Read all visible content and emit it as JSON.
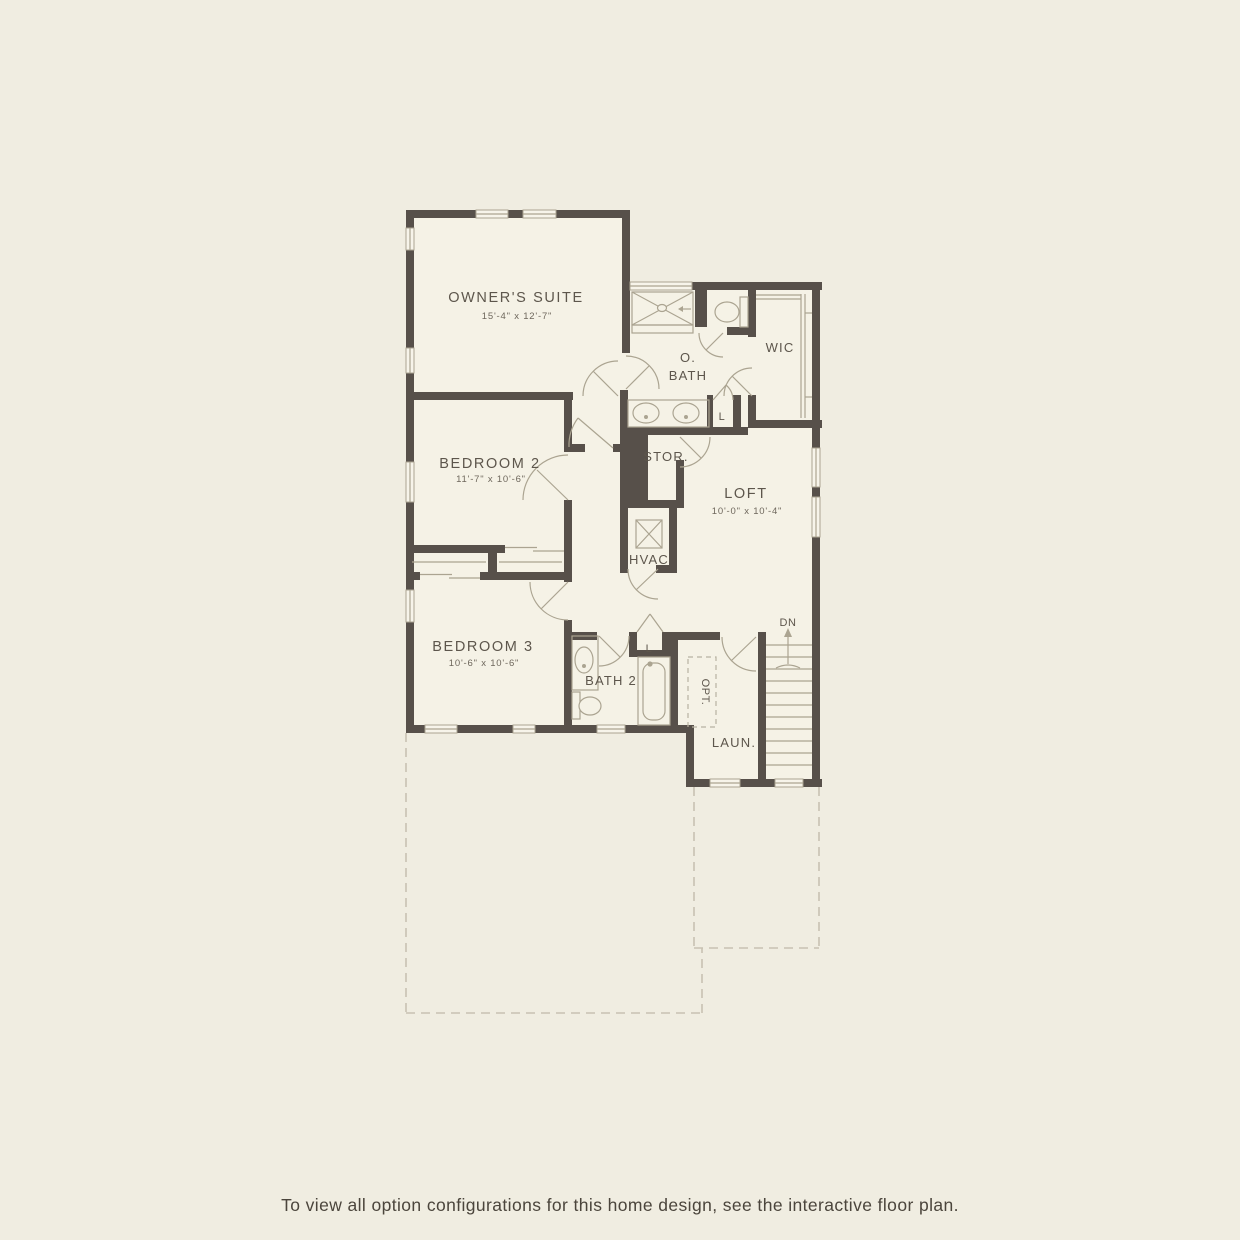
{
  "page": {
    "footer_note": "To view all option configurations for this home design, see the interactive floor plan."
  },
  "palette": {
    "background": "#f0ede1",
    "interior_floor": "#f5f2e6",
    "wall": "#57504a",
    "thin_line": "#aba491",
    "label_text": "#5d564c",
    "dashed_line": "#c8c2b2"
  },
  "floor_plan": {
    "rooms": {
      "owners_suite": {
        "name": "OWNER'S SUITE",
        "dims": "15'-4\" x 12'-7\""
      },
      "bedroom_2": {
        "name": "BEDROOM 2",
        "dims": "11'-7\" x 10'-6\""
      },
      "bedroom_3": {
        "name": "BEDROOM 3",
        "dims": "10'-6\" x 10'-6\""
      },
      "loft": {
        "name": "LOFT",
        "dims": "10'-0\" x 10'-4\""
      },
      "owners_bath": {
        "line1": "O.",
        "line2": "BATH"
      },
      "wic": {
        "name": "WIC"
      },
      "storage": {
        "name": "STOR."
      },
      "hvac": {
        "name": "HVAC"
      },
      "bath_2": {
        "name": "BATH 2"
      },
      "laundry": {
        "name": "LAUN."
      },
      "linen_bath": {
        "name": "L"
      },
      "linen_hall": {
        "name": "L"
      },
      "optional": {
        "name": "OPT."
      },
      "stairs_down": {
        "name": "DN"
      }
    }
  }
}
